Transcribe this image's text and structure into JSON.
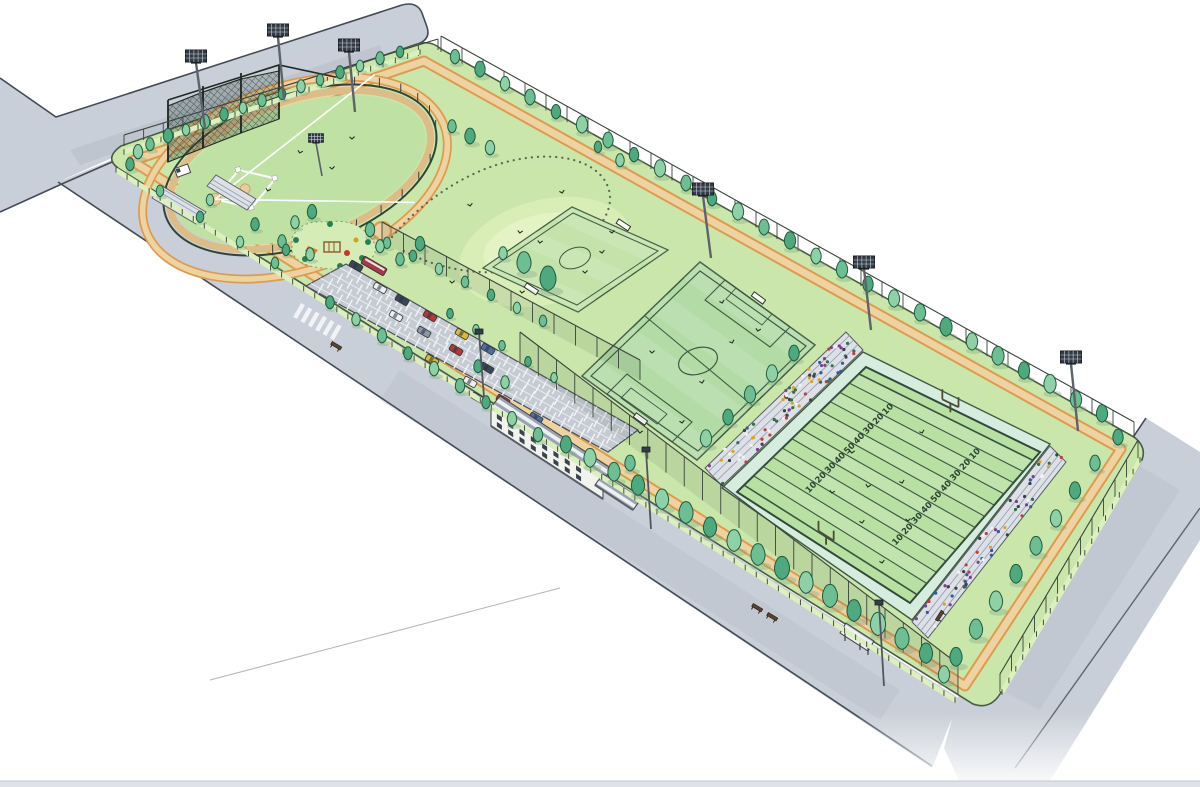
{
  "scene": {
    "kind": "sports-park-site-plan-illustration",
    "facilities": [
      "baseball-field",
      "playground",
      "multipurpose-lawn",
      "parking-lot",
      "practice-soccer-field",
      "main-soccer-field",
      "american-football-field",
      "clubhouse",
      "grandstands",
      "perimeter-jogging-path",
      "roads"
    ]
  },
  "football": {
    "yard_numbers": [
      "10",
      "20",
      "30",
      "40",
      "50",
      "40",
      "30",
      "20",
      "10"
    ]
  },
  "palette": {
    "road": "#c9cfd8",
    "road_shade": "#b2b9c6",
    "road_line": "#454b55",
    "site_green": "#cbe6ab",
    "lawn": "#c8e5a9",
    "mound": "#d9eeb6",
    "mound_hi": "#e4f3c4",
    "baseball_grass": "#bfe2a4",
    "infield_dirt": "#e6cc9e",
    "dirt_ring": "#dcbc87",
    "practice_field": "#c3e3ab",
    "soccer_field": "#b3dba6",
    "football_apron": "#d6ecdf",
    "football_grass": "#b9e0a3",
    "line_green": "#3f5a42",
    "path_tan": "#eed3a2",
    "path_orange": "#de9b4f",
    "panel_fence": "#dcefbe",
    "fence_dark": "#3a443c",
    "tree_greens": [
      "#4fa87e",
      "#6fbd92",
      "#8fd0a6",
      "#3e9671"
    ],
    "tree_line": "#1f5c40",
    "stand_gray": "#dde1e7",
    "building_white": "#f2f3ef",
    "window": "#3a434e",
    "tower_head": "#333b44",
    "bus_red": "#a8374a"
  },
  "car_colors": [
    "#b03a3a",
    "#d8b93c",
    "#eceff1",
    "#3a4656",
    "#4a6fa5",
    "#8c96a6"
  ],
  "cars": [
    [
      380,
      288,
      30,
      2
    ],
    [
      402,
      300,
      30,
      3
    ],
    [
      430,
      316,
      30,
      0
    ],
    [
      462,
      334,
      30,
      1
    ],
    [
      488,
      349,
      30,
      4
    ],
    [
      396,
      316,
      30,
      2
    ],
    [
      424,
      332,
      30,
      5
    ],
    [
      456,
      350,
      30,
      0
    ],
    [
      487,
      368,
      30,
      3
    ],
    [
      432,
      360,
      30,
      1
    ],
    [
      470,
      382,
      30,
      2
    ],
    [
      503,
      400,
      30,
      0
    ],
    [
      536,
      418,
      30,
      4
    ],
    [
      478,
      398,
      30,
      5
    ],
    [
      512,
      418,
      30,
      3
    ],
    [
      545,
      436,
      30,
      2
    ],
    [
      356,
      266,
      30,
      3
    ]
  ],
  "bus": {
    "x": 374,
    "y": 266,
    "deg": 30
  },
  "towers": [
    [
      196,
      56,
      205,
      128,
      1
    ],
    [
      278,
      30,
      284,
      99,
      1
    ],
    [
      349,
      45,
      355,
      112,
      1
    ],
    [
      316,
      138,
      322,
      176,
      0.7
    ],
    [
      703,
      189,
      711,
      258,
      1
    ],
    [
      864,
      262,
      871,
      330,
      1
    ],
    [
      1071,
      357,
      1078,
      431,
      1
    ]
  ],
  "lamps": [
    [
      479,
      333,
      484,
      397
    ],
    [
      646,
      451,
      651,
      529
    ],
    [
      879,
      604,
      884,
      686
    ]
  ],
  "stands": [
    {
      "name": "grandstand-northwest",
      "quad": [
        [
          722,
          486
        ],
        [
          863,
          350
        ],
        [
          846,
          332
        ],
        [
          705,
          468
        ]
      ],
      "count": 85
    },
    {
      "name": "grandstand-southeast",
      "quad": [
        [
          1050,
          446
        ],
        [
          912,
          622
        ],
        [
          928,
          638
        ],
        [
          1066,
          462
        ]
      ],
      "count": 60
    }
  ],
  "spectator_colors": [
    "#b8423d",
    "#31599e",
    "#d8a32a",
    "#f2f3f1",
    "#3b3f46",
    "#7e3f8f",
    "#356e46"
  ],
  "trees": [
    [
      150,
      150,
      9,
      1
    ],
    [
      168,
      142,
      10,
      0
    ],
    [
      186,
      135,
      8,
      2
    ],
    [
      205,
      128,
      10,
      1
    ],
    [
      224,
      120,
      9,
      0
    ],
    [
      243,
      113,
      8,
      2
    ],
    [
      262,
      106,
      9,
      1
    ],
    [
      282,
      99,
      8,
      0
    ],
    [
      301,
      92,
      9,
      2
    ],
    [
      320,
      85,
      8,
      1
    ],
    [
      340,
      78,
      9,
      0
    ],
    [
      360,
      71,
      8,
      2
    ],
    [
      380,
      64,
      9,
      1
    ],
    [
      400,
      57,
      8,
      0
    ],
    [
      138,
      158,
      10,
      2
    ],
    [
      130,
      170,
      9,
      0
    ],
    [
      455,
      63,
      10,
      1
    ],
    [
      480,
      76,
      11,
      0
    ],
    [
      505,
      90,
      10,
      2
    ],
    [
      530,
      104,
      11,
      1
    ],
    [
      556,
      118,
      10,
      0
    ],
    [
      582,
      132,
      12,
      2
    ],
    [
      608,
      147,
      11,
      1
    ],
    [
      634,
      161,
      10,
      0
    ],
    [
      660,
      176,
      12,
      2
    ],
    [
      686,
      190,
      11,
      1
    ],
    [
      712,
      205,
      10,
      0
    ],
    [
      738,
      219,
      12,
      2
    ],
    [
      764,
      234,
      11,
      1
    ],
    [
      790,
      248,
      12,
      0
    ],
    [
      816,
      263,
      11,
      2
    ],
    [
      842,
      277,
      12,
      1
    ],
    [
      868,
      291,
      11,
      0
    ],
    [
      894,
      306,
      12,
      2
    ],
    [
      920,
      320,
      12,
      1
    ],
    [
      946,
      335,
      13,
      0
    ],
    [
      972,
      349,
      12,
      2
    ],
    [
      998,
      364,
      13,
      1
    ],
    [
      1024,
      378,
      12,
      0
    ],
    [
      1050,
      392,
      13,
      2
    ],
    [
      1076,
      407,
      12,
      1
    ],
    [
      1102,
      421,
      12,
      0
    ],
    [
      1118,
      444,
      11,
      0
    ],
    [
      160,
      196,
      8,
      1
    ],
    [
      200,
      222,
      8,
      0
    ],
    [
      240,
      247,
      8,
      2
    ],
    [
      275,
      268,
      8,
      1
    ],
    [
      330,
      308,
      9,
      0
    ],
    [
      356,
      325,
      9,
      2
    ],
    [
      382,
      342,
      10,
      1
    ],
    [
      408,
      359,
      9,
      0
    ],
    [
      434,
      375,
      10,
      2
    ],
    [
      460,
      392,
      10,
      1
    ],
    [
      486,
      408,
      9,
      0
    ],
    [
      512,
      425,
      10,
      2
    ],
    [
      538,
      441,
      10,
      1
    ],
    [
      566,
      452,
      12,
      0
    ],
    [
      590,
      466,
      13,
      2
    ],
    [
      614,
      480,
      13,
      1
    ],
    [
      638,
      494,
      14,
      0
    ],
    [
      662,
      508,
      14,
      2
    ],
    [
      686,
      522,
      15,
      1
    ],
    [
      710,
      536,
      14,
      0
    ],
    [
      734,
      550,
      15,
      2
    ],
    [
      758,
      564,
      15,
      1
    ],
    [
      782,
      578,
      16,
      0
    ],
    [
      806,
      592,
      15,
      2
    ],
    [
      830,
      606,
      16,
      1
    ],
    [
      854,
      620,
      15,
      0
    ],
    [
      878,
      634,
      16,
      2
    ],
    [
      902,
      648,
      15,
      1
    ],
    [
      926,
      662,
      14,
      0
    ],
    [
      944,
      682,
      12,
      2
    ],
    [
      1095,
      470,
      11,
      1
    ],
    [
      1075,
      498,
      12,
      0
    ],
    [
      1056,
      526,
      12,
      2
    ],
    [
      1036,
      554,
      13,
      1
    ],
    [
      1016,
      582,
      13,
      0
    ],
    [
      996,
      610,
      14,
      2
    ],
    [
      976,
      638,
      14,
      1
    ],
    [
      956,
      665,
      13,
      0
    ],
    [
      706,
      446,
      12,
      2
    ],
    [
      728,
      424,
      11,
      0
    ],
    [
      750,
      402,
      12,
      1
    ],
    [
      772,
      381,
      12,
      2
    ],
    [
      794,
      360,
      11,
      0
    ],
    [
      524,
      272,
      15,
      1
    ],
    [
      548,
      289,
      17,
      0
    ],
    [
      503,
      259,
      9,
      2
    ],
    [
      470,
      143,
      11,
      0
    ],
    [
      490,
      154,
      10,
      2
    ],
    [
      452,
      132,
      9,
      1
    ],
    [
      598,
      152,
      8,
      0
    ],
    [
      620,
      166,
      9,
      2
    ],
    [
      295,
      228,
      9,
      2
    ],
    [
      312,
      218,
      10,
      0
    ],
    [
      370,
      236,
      10,
      1
    ],
    [
      380,
      252,
      9,
      2
    ],
    [
      286,
      255,
      8,
      0
    ],
    [
      387,
      248,
      8,
      1
    ],
    [
      413,
      261,
      8,
      0
    ],
    [
      439,
      274,
      8,
      2
    ],
    [
      465,
      287,
      8,
      1
    ],
    [
      491,
      300,
      8,
      0
    ],
    [
      517,
      313,
      8,
      2
    ],
    [
      543,
      326,
      8,
      1
    ],
    [
      450,
      318,
      7,
      0
    ],
    [
      476,
      334,
      7,
      2
    ],
    [
      502,
      350,
      7,
      1
    ],
    [
      528,
      366,
      7,
      0
    ],
    [
      554,
      382,
      7,
      2
    ],
    [
      505,
      388,
      9,
      2
    ],
    [
      478,
      372,
      9,
      0
    ],
    [
      630,
      470,
      11,
      1
    ],
    [
      255,
      230,
      9,
      0
    ],
    [
      282,
      247,
      9,
      1
    ],
    [
      210,
      205,
      8,
      2
    ],
    [
      310,
      260,
      9,
      2
    ],
    [
      420,
      250,
      10,
      0
    ],
    [
      400,
      265,
      9,
      1
    ]
  ],
  "marks": [
    [
      300,
      152
    ],
    [
      332,
      168
    ],
    [
      268,
      190
    ],
    [
      352,
      138
    ],
    [
      470,
      205
    ],
    [
      520,
      232
    ],
    [
      562,
      192
    ],
    [
      602,
      252
    ],
    [
      452,
      282
    ],
    [
      540,
      242
    ],
    [
      585,
      272
    ],
    [
      522,
      292
    ],
    [
      612,
      232
    ],
    [
      652,
      352
    ],
    [
      702,
      382
    ],
    [
      732,
      342
    ],
    [
      682,
      422
    ],
    [
      722,
      302
    ],
    [
      852,
      452
    ],
    [
      902,
      482
    ],
    [
      862,
      522
    ],
    [
      922,
      432
    ],
    [
      882,
      562
    ],
    [
      832,
      492
    ],
    [
      868,
      486
    ],
    [
      908,
      520
    ],
    [
      640,
      432
    ],
    [
      758,
      330
    ]
  ],
  "benches": [
    [
      336,
      346,
      31
    ],
    [
      757,
      608,
      31
    ],
    [
      772,
      617,
      31
    ],
    [
      940,
      616,
      -58
    ]
  ],
  "parking": {
    "quad": [
      [
        346,
        264
      ],
      [
        638,
        430
      ],
      [
        608,
        452
      ],
      [
        306,
        286
      ]
    ],
    "rows": 4
  },
  "crosswalk": {
    "x": 299,
    "y": 311,
    "deg": 30,
    "bars": 6,
    "step": 8.5
  }
}
